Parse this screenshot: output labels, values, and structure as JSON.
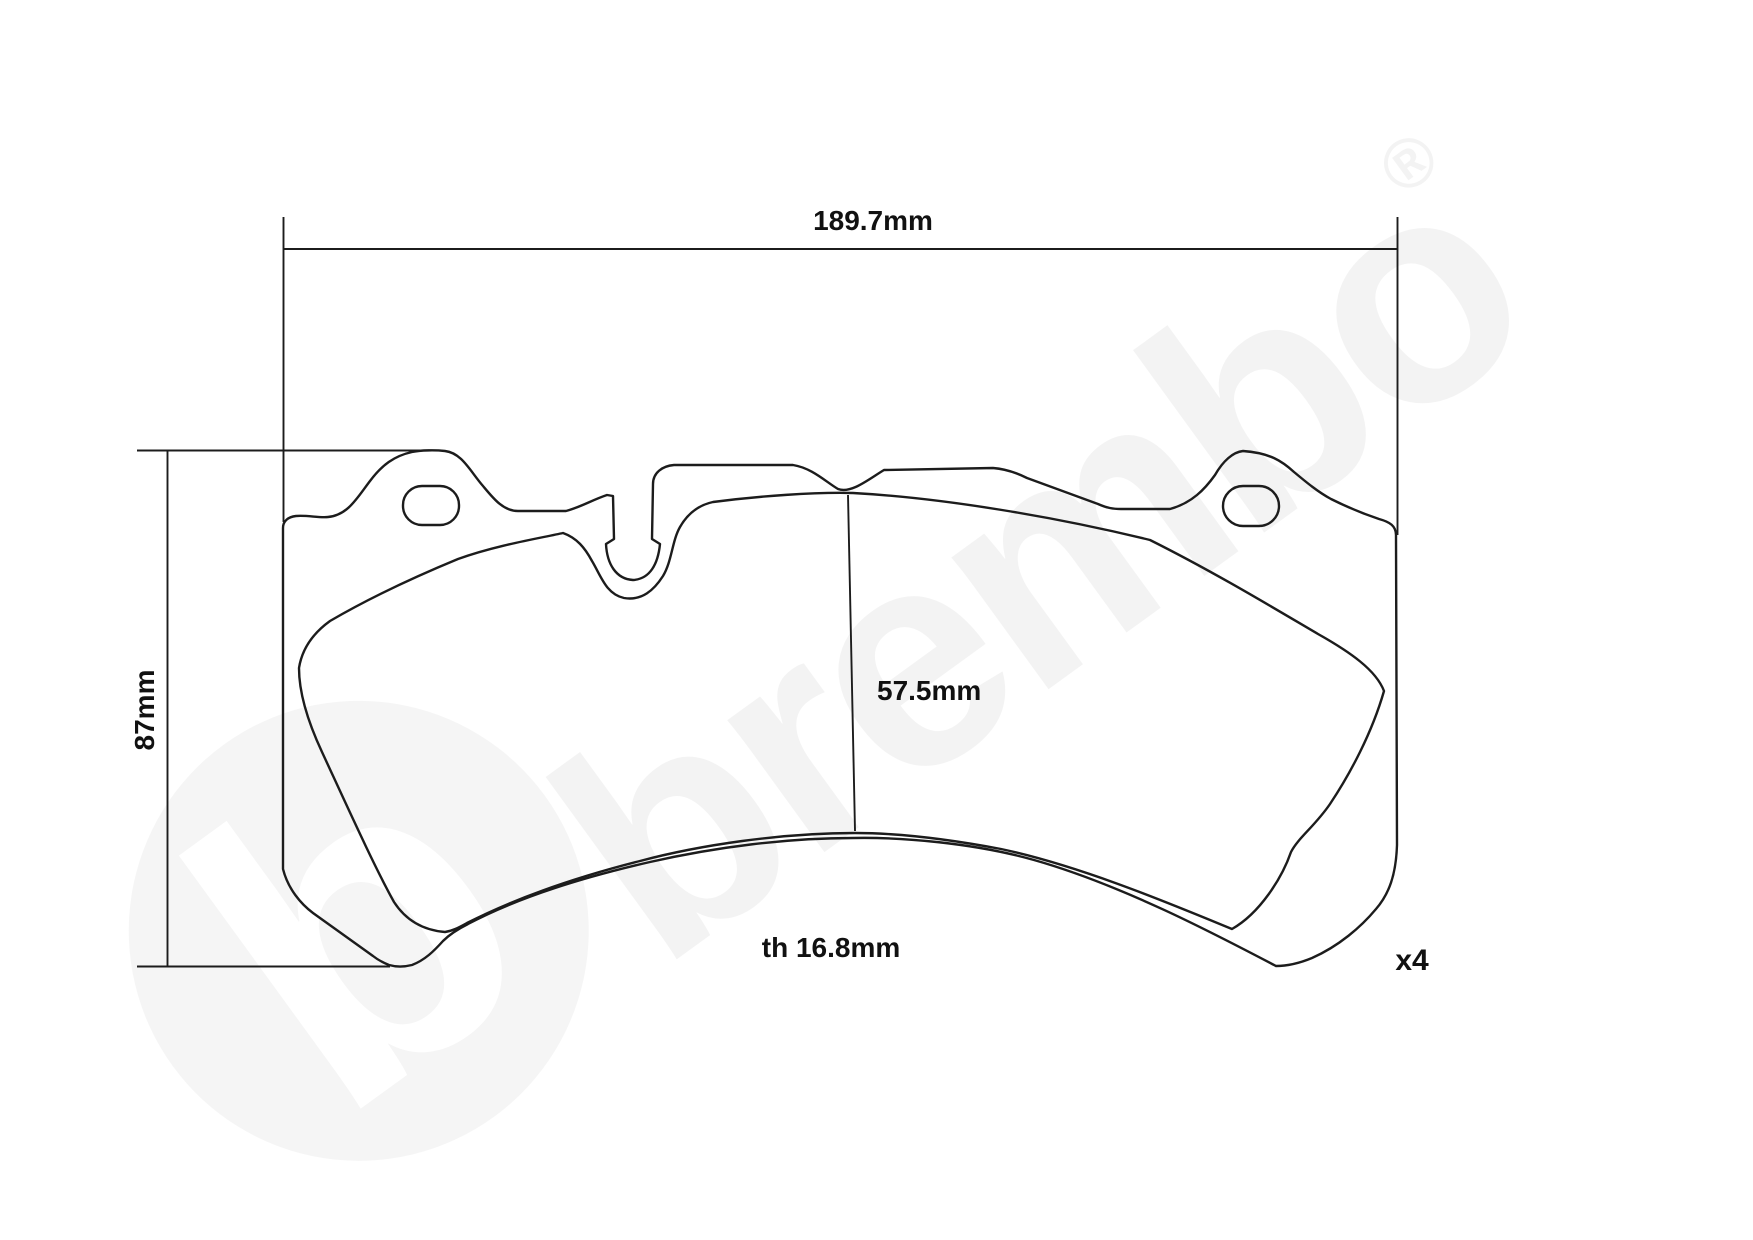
{
  "drawing": {
    "title": "brake-pad-technical-drawing",
    "labels": {
      "width": "189.7mm",
      "height": "87mm",
      "pad_height": "57.5mm",
      "thickness": "th 16.8mm",
      "quantity": "x4"
    },
    "watermark": {
      "text": "brembo",
      "logo_letter": "b",
      "registered_mark": "®"
    }
  },
  "colors": {
    "line": "#1c1c1c",
    "text": "#111111",
    "background": "#ffffff",
    "watermark": "#000000"
  }
}
